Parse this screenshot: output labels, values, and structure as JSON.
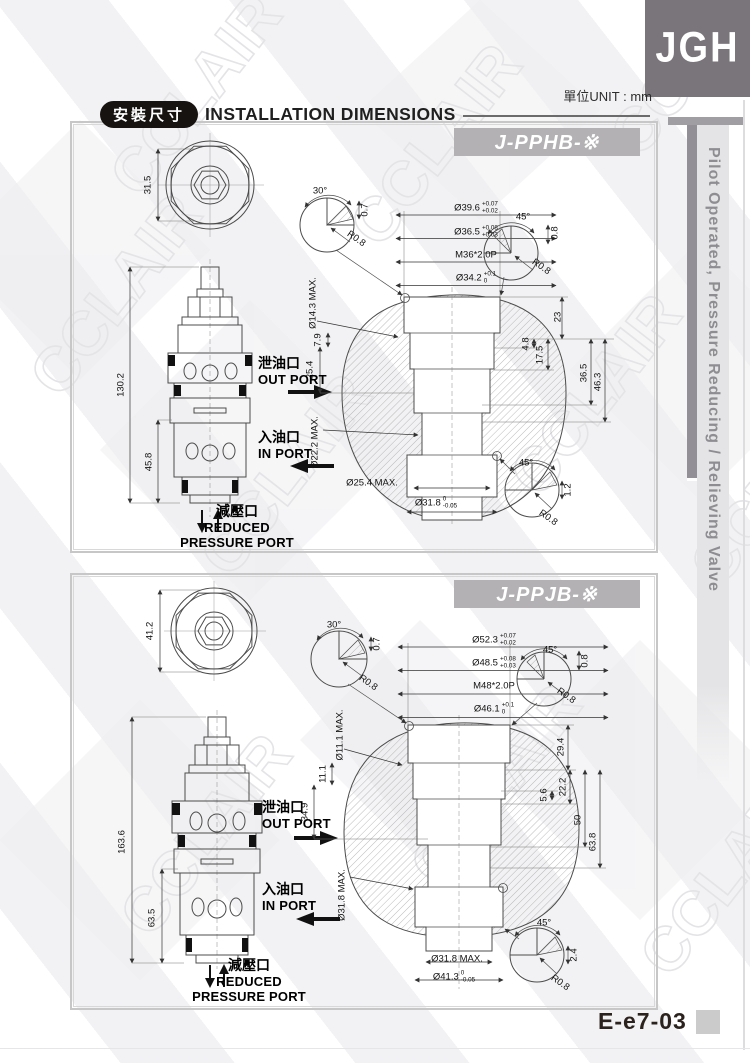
{
  "page": {
    "logo": "JGH",
    "unit_label": "單位UNIT : mm",
    "header": {
      "zh": "安裝尺寸",
      "en": "INSTALLATION DIMENSIONS"
    },
    "sidebar_text": "Pilot Operated, Pressure Reducing / Relieving Valve",
    "page_code": "E-e7-03",
    "watermark": "CCLAIR"
  },
  "ports": {
    "out": {
      "zh": "泄油口",
      "en": "OUT PORT"
    },
    "in": {
      "zh": "入油口",
      "en": "IN PORT"
    },
    "reduced": {
      "zh": "減壓口",
      "en1": "REDUCED",
      "en2": "PRESSURE PORT"
    }
  },
  "panels": [
    {
      "model": "J-PPHB-※",
      "dim_labels": [
        {
          "t": "31.5",
          "x": 74,
          "y": 60,
          "r": -90
        },
        {
          "t": "130.2",
          "x": 47,
          "y": 260,
          "r": -90
        },
        {
          "t": "45.8",
          "x": 75,
          "y": 337,
          "r": -90
        },
        {
          "t": "30°",
          "x": 246,
          "y": 66
        },
        {
          "t": "0.7",
          "x": 291,
          "y": 85,
          "r": -90
        },
        {
          "t": "R0.8",
          "x": 282,
          "y": 114,
          "r": 35
        },
        {
          "t": "Ø39.6",
          "tol": [
            "+0.07",
            "+0.02"
          ],
          "x": 402,
          "y": 83
        },
        {
          "t": "Ø36.5",
          "tol": [
            "+0.08",
            "+0.03"
          ],
          "x": 402,
          "y": 107
        },
        {
          "t": "M36*2.0P",
          "x": 402,
          "y": 130
        },
        {
          "t": "Ø34.2",
          "tol": [
            "+0.1",
            "0"
          ],
          "x": 402,
          "y": 153
        },
        {
          "t": "Ø14.3 MAX.",
          "x": 239,
          "y": 178,
          "r": -90
        },
        {
          "t": "7.9",
          "x": 244,
          "y": 215,
          "r": -90
        },
        {
          "t": "25.4",
          "x": 236,
          "y": 245,
          "r": -90
        },
        {
          "t": "Ø22.2 MAX.",
          "x": 241,
          "y": 317,
          "r": -90
        },
        {
          "t": "Ø25.4 MAX.",
          "x": 298,
          "y": 358
        },
        {
          "t": "Ø31.8",
          "tol": [
            "0",
            "-0.05"
          ],
          "x": 362,
          "y": 378
        },
        {
          "t": "23",
          "x": 484,
          "y": 192,
          "r": -90
        },
        {
          "t": "4.8",
          "x": 452,
          "y": 219,
          "r": -90
        },
        {
          "t": "17.5",
          "x": 466,
          "y": 230,
          "r": -90
        },
        {
          "t": "36.5",
          "x": 510,
          "y": 248,
          "r": -90
        },
        {
          "t": "46.3",
          "x": 524,
          "y": 257,
          "r": -90
        },
        {
          "t": "45°",
          "x": 449,
          "y": 92
        },
        {
          "t": "0.8",
          "x": 481,
          "y": 108,
          "r": -90
        },
        {
          "t": "R0.8",
          "x": 467,
          "y": 142,
          "r": 35
        },
        {
          "t": "45°",
          "x": 452,
          "y": 338
        },
        {
          "t": "1.2",
          "x": 494,
          "y": 365,
          "r": -90
        },
        {
          "t": "R0.8",
          "x": 474,
          "y": 393,
          "r": 35
        }
      ]
    },
    {
      "model": "J-PPJB-※",
      "dim_labels": [
        {
          "t": "41.2",
          "x": 76,
          "y": 54,
          "r": -90
        },
        {
          "t": "163.6",
          "x": 48,
          "y": 265,
          "r": -90
        },
        {
          "t": "63.5",
          "x": 78,
          "y": 341,
          "r": -90
        },
        {
          "t": "30°",
          "x": 260,
          "y": 48
        },
        {
          "t": "0.7",
          "x": 303,
          "y": 67,
          "r": -90
        },
        {
          "t": "R0.8",
          "x": 294,
          "y": 106,
          "r": 35
        },
        {
          "t": "Ø52.3",
          "tol": [
            "+0.07",
            "+0.02"
          ],
          "x": 420,
          "y": 63
        },
        {
          "t": "Ø48.5",
          "tol": [
            "+0.08",
            "+0.03"
          ],
          "x": 420,
          "y": 86
        },
        {
          "t": "M48*2.0P",
          "x": 420,
          "y": 109
        },
        {
          "t": "Ø46.1",
          "tol": [
            "+0.1",
            "0"
          ],
          "x": 420,
          "y": 132
        },
        {
          "t": "Ø11.1 MAX.",
          "x": 266,
          "y": 158,
          "r": -90
        },
        {
          "t": "11.1",
          "x": 249,
          "y": 197,
          "r": -90
        },
        {
          "t": "34.9",
          "x": 231,
          "y": 235,
          "r": -90
        },
        {
          "t": "Ø31.8 MAX.",
          "x": 268,
          "y": 318,
          "r": -90
        },
        {
          "t": "Ø31.8 MAX.",
          "x": 383,
          "y": 382
        },
        {
          "t": "Ø41.3",
          "tol": [
            "0",
            "-0.05"
          ],
          "x": 380,
          "y": 400
        },
        {
          "t": "29.4",
          "x": 487,
          "y": 170,
          "r": -90
        },
        {
          "t": "5.6",
          "x": 470,
          "y": 218,
          "r": -90
        },
        {
          "t": "22.2",
          "x": 489,
          "y": 210,
          "r": -90
        },
        {
          "t": "50",
          "x": 504,
          "y": 243,
          "r": -90
        },
        {
          "t": "63.8",
          "x": 519,
          "y": 265,
          "r": -90
        },
        {
          "t": "45°",
          "x": 476,
          "y": 73
        },
        {
          "t": "0.8",
          "x": 511,
          "y": 84,
          "r": -90
        },
        {
          "t": "R0.8",
          "x": 492,
          "y": 119,
          "r": 35
        },
        {
          "t": "45°",
          "x": 470,
          "y": 346
        },
        {
          "t": "2.4",
          "x": 500,
          "y": 378,
          "r": -90
        },
        {
          "t": "R0.8",
          "x": 486,
          "y": 406,
          "r": 35
        }
      ]
    }
  ]
}
